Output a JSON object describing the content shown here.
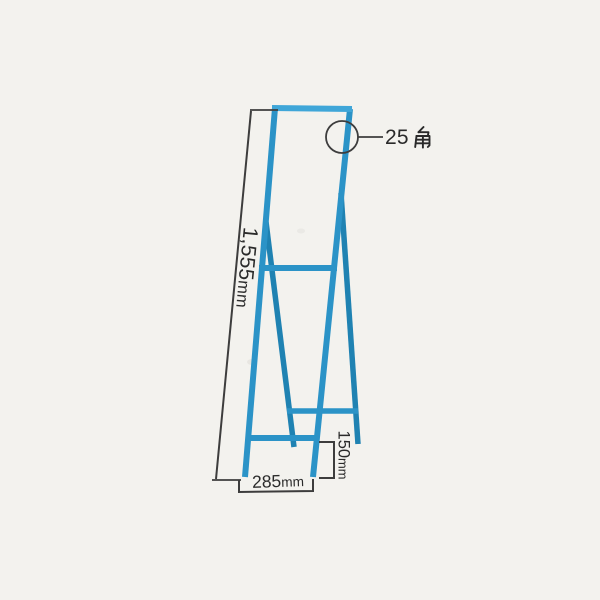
{
  "colors": {
    "background": "#f3f2ee",
    "frame_light": "#3fa6d8",
    "frame_main": "#2b93c7",
    "frame_dark": "#1f82b2",
    "annotation": "#3d3d3d",
    "text": "#2a2a2a"
  },
  "annotations": {
    "overall_height": {
      "value": "1,555",
      "unit": "mm",
      "label": "1,555mm"
    },
    "base_width": {
      "value": "285",
      "unit": "mm",
      "label": "285mm"
    },
    "bottom_rung_height": {
      "value": "150",
      "unit": "mm",
      "label": "150mm"
    },
    "tube_size": {
      "number": "25",
      "kanji": "角",
      "label": "25角"
    }
  }
}
